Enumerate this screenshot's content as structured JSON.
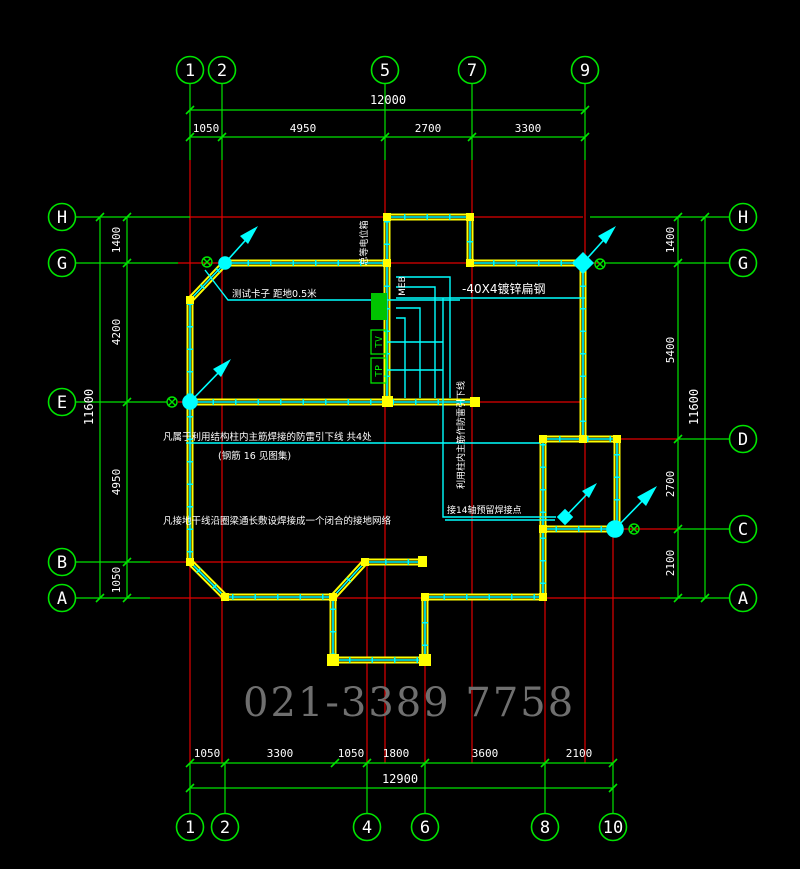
{
  "watermark": "021-3389 7758",
  "axes": {
    "top": [
      "1",
      "2",
      "5",
      "7",
      "9"
    ],
    "bottom": [
      "1",
      "2",
      "4",
      "6",
      "8",
      "10"
    ],
    "left": [
      "H",
      "G",
      "E",
      "B",
      "A"
    ],
    "right": [
      "H",
      "G",
      "D",
      "C",
      "A"
    ]
  },
  "dimensions": {
    "top": {
      "total": "12000",
      "segments": [
        "1050",
        "4950",
        "2700",
        "3300"
      ]
    },
    "bottom": {
      "total": "12900",
      "segments": [
        "1050",
        "3300",
        "1050",
        "1800",
        "3600",
        "2100"
      ]
    },
    "left": {
      "total": "11600",
      "segments": [
        "1400",
        "4200",
        "4950",
        "1050"
      ]
    },
    "right": {
      "total": "11600",
      "segments": [
        "1400",
        "5400",
        "2700",
        "2100"
      ]
    }
  },
  "annotations": {
    "test_clamp": "测试卡子 距地0.5米",
    "flat_steel": "-40X4镀锌扁钢",
    "downlead_note_line1": "凡属于利用结构柱内主筋焊接的防雷引下线 共4处",
    "downlead_note_line2": "(钢筋 16 见图集)",
    "ring_note": "凡接地干线沿圈梁通长敷设焊接成一个闭合的接地网络",
    "weld_point_note": "接14轴预留焊接点",
    "riser_note": "利用柱内主筋作防雷引下线",
    "meb_label": "MEB",
    "meb_box_label": "总等电位箱",
    "tv_label": "TV",
    "tp_label": "TP"
  },
  "colors": {
    "grid_green": "#00e400",
    "grid_red": "#e00000",
    "wall_yellow": "#ffff00",
    "conductor_cyan": "#00ffff",
    "text_white": "#ffffff",
    "watermark_gray": "#6f6f6f"
  }
}
